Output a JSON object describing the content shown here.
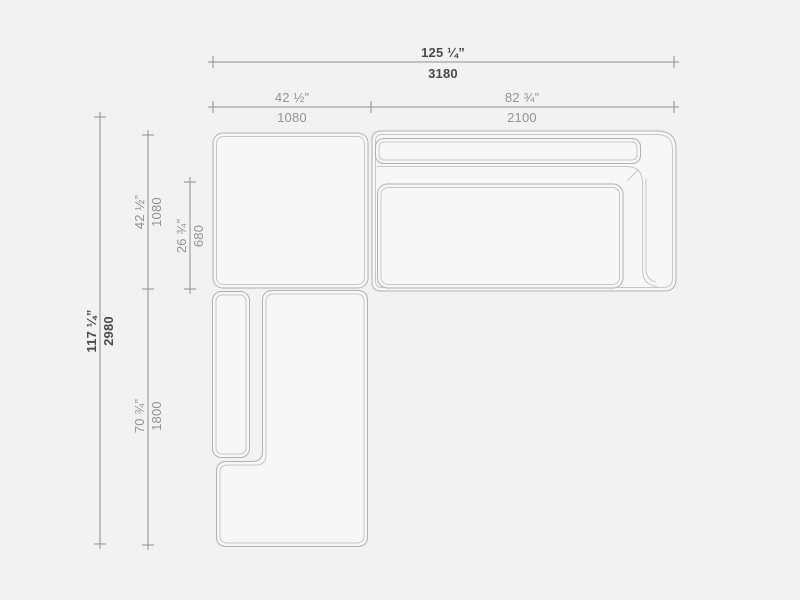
{
  "drawing": {
    "title": "sectional-sofa-top-view-dimension-drawing",
    "units": [
      "inches",
      "millimeters"
    ]
  },
  "dimensions": {
    "overall_width": {
      "inches": "125 ¼”",
      "mm": "3180"
    },
    "corner_module_width": {
      "inches": "42 ½”",
      "mm": "1080"
    },
    "sofa_section_width": {
      "inches": "82 ¾”",
      "mm": "2100"
    },
    "overall_depth": {
      "inches": "117 ¼”",
      "mm": "2980"
    },
    "corner_module_depth": {
      "inches": "42 ½”",
      "mm": "1080"
    },
    "seat_depth": {
      "inches": "26 ¾”",
      "mm": "680"
    },
    "chaise_length": {
      "inches": "70 ¾”",
      "mm": "1800"
    }
  },
  "colors": {
    "background": "#f2f2f2",
    "module_fill": "#f7f7f7",
    "outline": "#b0b0b0",
    "seam": "#c7c7c7",
    "dimension_line": "#8e8e8e",
    "dimension_text": "#939393",
    "dimension_text_emphasis": "#4a4a4a"
  }
}
